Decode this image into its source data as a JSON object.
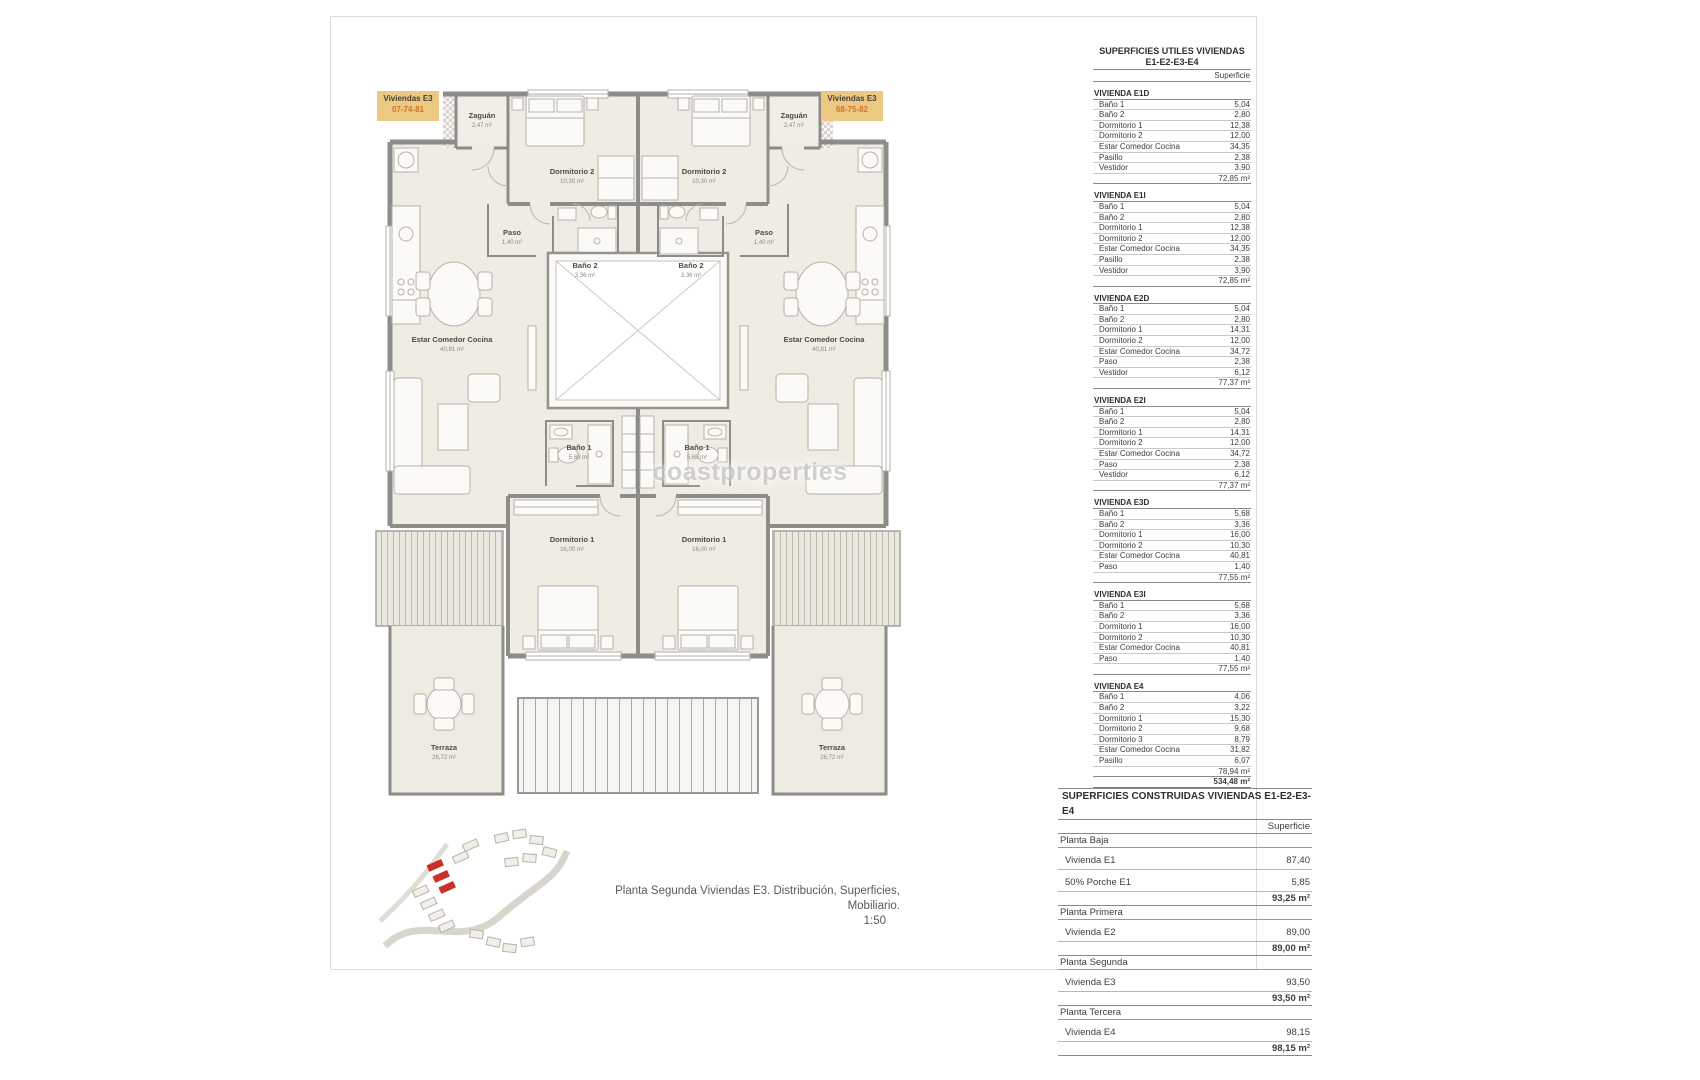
{
  "colors": {
    "unit_label_bg": "#ecc983",
    "unit_label_code": "#d0742a",
    "site_highlight": "#c9302a",
    "wall": "#8c8c89",
    "floor": "#efece4"
  },
  "unit_labels": {
    "left": {
      "title": "Viviendas E3",
      "code": "07-74-81"
    },
    "right": {
      "title": "Viviendas E3",
      "code": "68-75-82"
    }
  },
  "plan_rooms": {
    "zaguan": {
      "name": "Zaguán",
      "area": "2,47 m²"
    },
    "dormitorio2": {
      "name": "Dormitorio 2",
      "area": "10,30 m²"
    },
    "paso": {
      "name": "Paso",
      "area": "1,40 m²"
    },
    "bano2": {
      "name": "Baño 2",
      "area": "3,36 m²"
    },
    "estar_comedor_cocina": {
      "name": "Estar Comedor Cocina",
      "area": "40,81 m²"
    },
    "bano1": {
      "name": "Baño 1",
      "area": "5,68 m²"
    },
    "dormitorio1": {
      "name": "Dormitorio 1",
      "area": "16,00 m²"
    },
    "terraza": {
      "name": "Terraza",
      "area": "26,72 m²"
    }
  },
  "watermark": "coastproperties",
  "caption": {
    "line1": "Planta Segunda Viviendas E3. Distribución, Superficies, Mobiliario.",
    "line2": "1:50"
  },
  "tables": {
    "utiles": {
      "title_line1": "SUPERFICIES UTILES VIVIENDAS",
      "title_line2": "E1-E2-E3-E4",
      "col_header": "Superficie",
      "rows": [
        {
          "kind": "sec",
          "label": "VIVIENDA E1D",
          "value": ""
        },
        {
          "kind": "item",
          "label": "Baño 1",
          "value": "5,04"
        },
        {
          "kind": "item",
          "label": "Baño 2",
          "value": "2,80"
        },
        {
          "kind": "item",
          "label": "Dormitorio 1",
          "value": "12,38"
        },
        {
          "kind": "item",
          "label": "Dormitorio 2",
          "value": "12,00"
        },
        {
          "kind": "item",
          "label": "Estar Comedor Cocina",
          "value": "34,35"
        },
        {
          "kind": "item",
          "label": "Pasillo",
          "value": "2,38"
        },
        {
          "kind": "item",
          "label": "Vestidor",
          "value": "3,90"
        },
        {
          "kind": "total",
          "label": "",
          "value": "72,85 m²"
        },
        {
          "kind": "sec",
          "label": "VIVIENDA E1I",
          "value": ""
        },
        {
          "kind": "item",
          "label": "Baño 1",
          "value": "5,04"
        },
        {
          "kind": "item",
          "label": "Baño 2",
          "value": "2,80"
        },
        {
          "kind": "item",
          "label": "Dormitorio 1",
          "value": "12,38"
        },
        {
          "kind": "item",
          "label": "Dormitorio 2",
          "value": "12,00"
        },
        {
          "kind": "item",
          "label": "Estar Comedor Cocina",
          "value": "34,35"
        },
        {
          "kind": "item",
          "label": "Pasillo",
          "value": "2,38"
        },
        {
          "kind": "item",
          "label": "Vestidor",
          "value": "3,90"
        },
        {
          "kind": "total",
          "label": "",
          "value": "72,85 m²"
        },
        {
          "kind": "sec",
          "label": "VIVIENDA E2D",
          "value": ""
        },
        {
          "kind": "item",
          "label": "Baño 1",
          "value": "5,04"
        },
        {
          "kind": "item",
          "label": "Baño 2",
          "value": "2,80"
        },
        {
          "kind": "item",
          "label": "Dormitorio 1",
          "value": "14,31"
        },
        {
          "kind": "item",
          "label": "Dormitorio 2",
          "value": "12,00"
        },
        {
          "kind": "item",
          "label": "Estar Comedor Cocina",
          "value": "34,72"
        },
        {
          "kind": "item",
          "label": "Paso",
          "value": "2,38"
        },
        {
          "kind": "item",
          "label": "Vestidor",
          "value": "6,12"
        },
        {
          "kind": "total",
          "label": "",
          "value": "77,37 m²"
        },
        {
          "kind": "sec",
          "label": "VIVIENDA E2I",
          "value": ""
        },
        {
          "kind": "item",
          "label": "Baño 1",
          "value": "5,04"
        },
        {
          "kind": "item",
          "label": "Baño 2",
          "value": "2,80"
        },
        {
          "kind": "item",
          "label": "Dormitorio 1",
          "value": "14,31"
        },
        {
          "kind": "item",
          "label": "Dormitorio 2",
          "value": "12,00"
        },
        {
          "kind": "item",
          "label": "Estar Comedor Cocina",
          "value": "34,72"
        },
        {
          "kind": "item",
          "label": "Paso",
          "value": "2,38"
        },
        {
          "kind": "item",
          "label": "Vestidor",
          "value": "6,12"
        },
        {
          "kind": "total",
          "label": "",
          "value": "77,37 m²"
        },
        {
          "kind": "sec",
          "label": "VIVIENDA E3D",
          "value": ""
        },
        {
          "kind": "item",
          "label": "Baño 1",
          "value": "5,68"
        },
        {
          "kind": "item",
          "label": "Baño 2",
          "value": "3,36"
        },
        {
          "kind": "item",
          "label": "Dormitorio 1",
          "value": "16,00"
        },
        {
          "kind": "item",
          "label": "Dormitorio 2",
          "value": "10,30"
        },
        {
          "kind": "item",
          "label": "Estar Comedor Cocina",
          "value": "40,81"
        },
        {
          "kind": "item",
          "label": "Paso",
          "value": "1,40"
        },
        {
          "kind": "total",
          "label": "",
          "value": "77,55 m²"
        },
        {
          "kind": "sec",
          "label": "VIVIENDA E3I",
          "value": ""
        },
        {
          "kind": "item",
          "label": "Baño 1",
          "value": "5,68"
        },
        {
          "kind": "item",
          "label": "Baño 2",
          "value": "3,36"
        },
        {
          "kind": "item",
          "label": "Dormitorio 1",
          "value": "16,00"
        },
        {
          "kind": "item",
          "label": "Dormitorio 2",
          "value": "10,30"
        },
        {
          "kind": "item",
          "label": "Estar Comedor Cocina",
          "value": "40,81"
        },
        {
          "kind": "item",
          "label": "Paso",
          "value": "1,40"
        },
        {
          "kind": "total",
          "label": "",
          "value": "77,55 m²"
        },
        {
          "kind": "sec",
          "label": "VIVIENDA E4",
          "value": ""
        },
        {
          "kind": "item",
          "label": "Baño 1",
          "value": "4,06"
        },
        {
          "kind": "item",
          "label": "Baño 2",
          "value": "3,22"
        },
        {
          "kind": "item",
          "label": "Dormitorio 1",
          "value": "15,30"
        },
        {
          "kind": "item",
          "label": "Dormitorio 2",
          "value": "9,68"
        },
        {
          "kind": "item",
          "label": "Dormitorio 3",
          "value": "8,79"
        },
        {
          "kind": "item",
          "label": "Estar Comedor Cocina",
          "value": "31,82"
        },
        {
          "kind": "item",
          "label": "Pasillo",
          "value": "6,07"
        },
        {
          "kind": "total",
          "label": "",
          "value": "78,94 m²"
        },
        {
          "kind": "grand",
          "label": "",
          "value": "534,48 m²"
        }
      ]
    },
    "construidas": {
      "title": "SUPERFICIES CONSTRUIDAS VIVIENDAS E1-E2-E3-E4",
      "col_header": "Superficie",
      "rows": [
        {
          "kind": "sec",
          "label": "Planta Baja",
          "value": ""
        },
        {
          "kind": "item",
          "label": "Vivienda E1",
          "value": "87,40"
        },
        {
          "kind": "item",
          "label": "50% Porche E1",
          "value": "5,85"
        },
        {
          "kind": "total",
          "label": "",
          "value": "93,25 m²"
        },
        {
          "kind": "sec",
          "label": "Planta Primera",
          "value": ""
        },
        {
          "kind": "item",
          "label": "Vivienda E2",
          "value": "89,00"
        },
        {
          "kind": "total",
          "label": "",
          "value": "89,00 m²"
        },
        {
          "kind": "sec",
          "label": "Planta Segunda",
          "value": ""
        },
        {
          "kind": "item",
          "label": "Vivienda E3",
          "value": "93,50"
        },
        {
          "kind": "total",
          "label": "",
          "value": "93,50 m²"
        },
        {
          "kind": "sec",
          "label": "Planta Tercera",
          "value": ""
        },
        {
          "kind": "item",
          "label": "Vivienda E4",
          "value": "98,15"
        },
        {
          "kind": "total",
          "label": "",
          "value": "98,15 m²"
        }
      ]
    }
  }
}
